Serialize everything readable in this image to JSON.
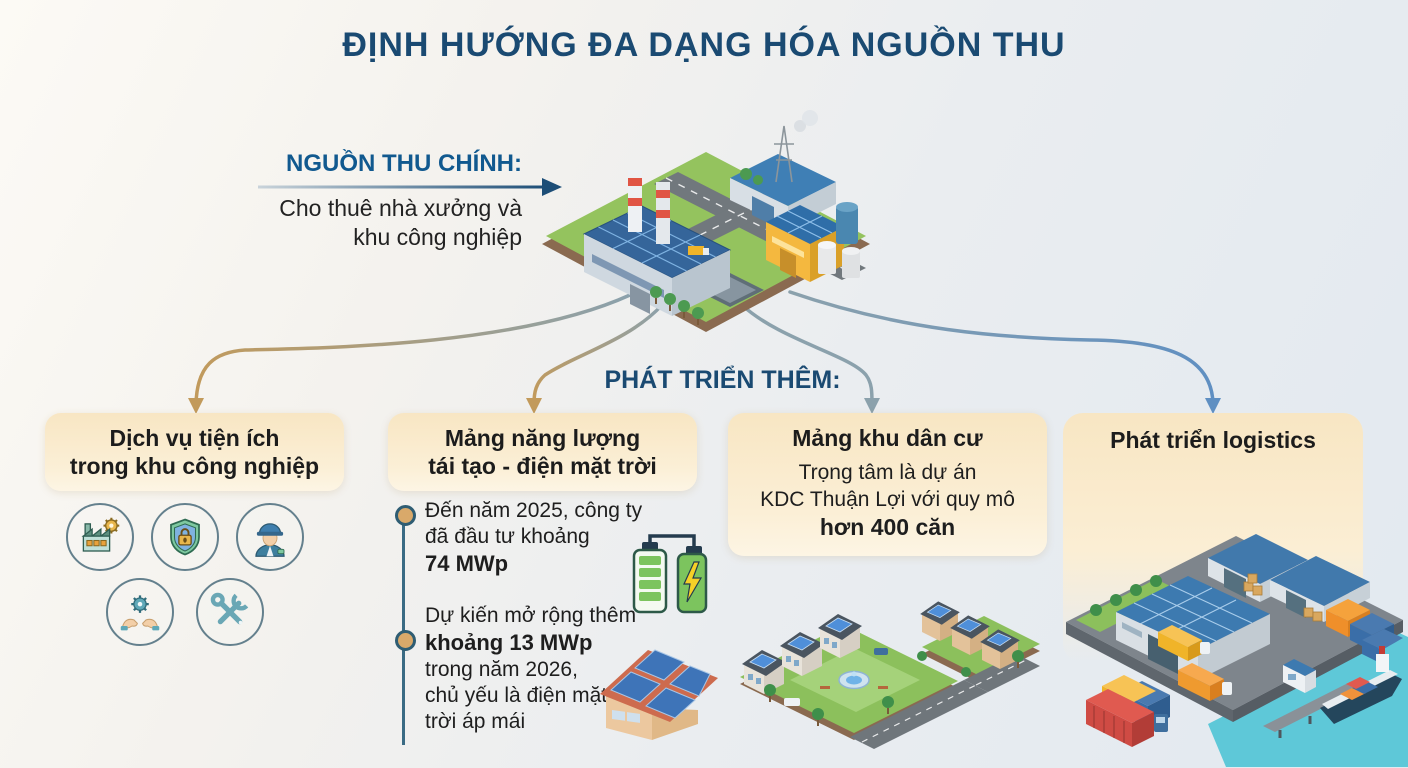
{
  "title": "ĐỊNH HƯỚNG ĐA DẠNG HÓA NGUỒN THU",
  "main_source": {
    "label": "NGUỒN THU CHÍNH:",
    "line1": "Cho thuê nhà xưởng và",
    "line2": "khu công nghiệp"
  },
  "develop_label": "PHÁT TRIỂN THÊM:",
  "cards": [
    {
      "id": "utilities",
      "title_line1": "Dịch vụ tiện ích",
      "title_line2": "trong khu công nghiệp",
      "icons": [
        "factory-gear",
        "security-shield",
        "engineer-worker",
        "service-hands",
        "repair-tools"
      ]
    },
    {
      "id": "renewable-energy",
      "title_line1": "Mảng năng lượng",
      "title_line2": "tái tạo - điện mặt trời",
      "bullets": [
        {
          "l1": "Đến năm 2025, công ty",
          "l2": "đã đầu tư khoảng",
          "l3_bold": "74 MWp"
        },
        {
          "l1": "Dự kiến mở rộng thêm",
          "l2_bold": "khoảng 13 MWp",
          "l3": "trong năm 2026,",
          "l4": "chủ yếu là điện mặt",
          "l5": "trời áp mái"
        }
      ]
    },
    {
      "id": "residential",
      "title": "Mảng khu dân cư",
      "desc_line1": "Trọng tâm là dự án",
      "desc_line2": "KDC Thuận Lợi với quy mô",
      "desc_line3_bold": "hơn 400 căn"
    },
    {
      "id": "logistics",
      "title": "Phát triển logistics"
    }
  ],
  "colors": {
    "navy": "#1a4a72",
    "label_blue": "#11598f",
    "card_cream": "#f8e6c3",
    "arrow_tan": "#c29a5b",
    "arrow_slate": "#8ba1ac",
    "arrow_blue": "#5f8fc2"
  }
}
